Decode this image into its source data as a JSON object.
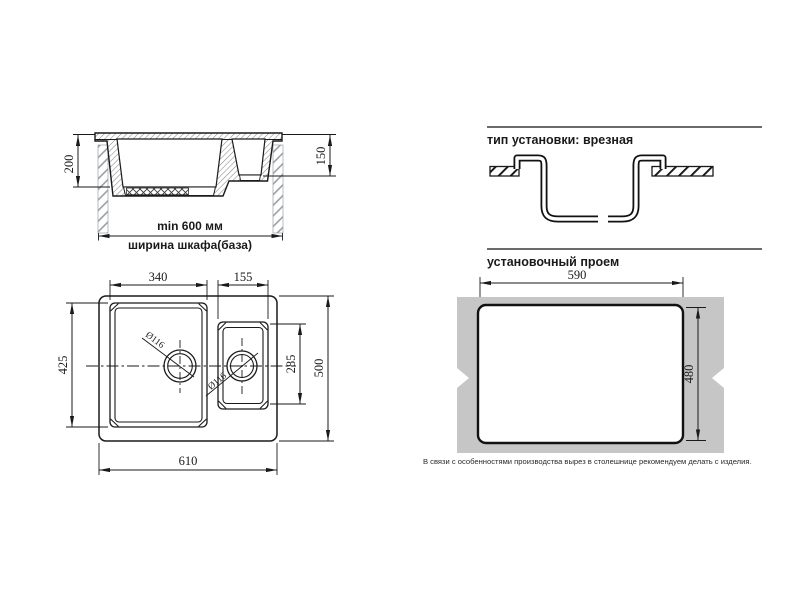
{
  "drawing": {
    "side_view": {
      "dim_bowl_depth_main": "200",
      "dim_bowl_depth_small": "150",
      "dim_cabinet_min_width": "min 600 мм",
      "cabinet_width_label": "ширина шкафа(база)"
    },
    "top_view": {
      "dim_main_bowl_width": "340",
      "dim_small_bowl_width": "155",
      "dim_main_bowl_length": "425",
      "dim_small_bowl_length": "285",
      "dim_overall_length": "500",
      "dim_overall_width": "610",
      "dim_drain_main": "Ø116",
      "dim_drain_small": "Ø116"
    },
    "installation": {
      "type_heading": "тип установки: врезная",
      "opening_heading": "установочный проем",
      "dim_opening_width": "590",
      "dim_opening_height": "480",
      "note": "В связи с особенностями производства вырез в столешнице рекомендуем делать с изделия."
    },
    "colors": {
      "line": "#1a1a1a",
      "countertop_gray": "#c6c6c6"
    }
  }
}
